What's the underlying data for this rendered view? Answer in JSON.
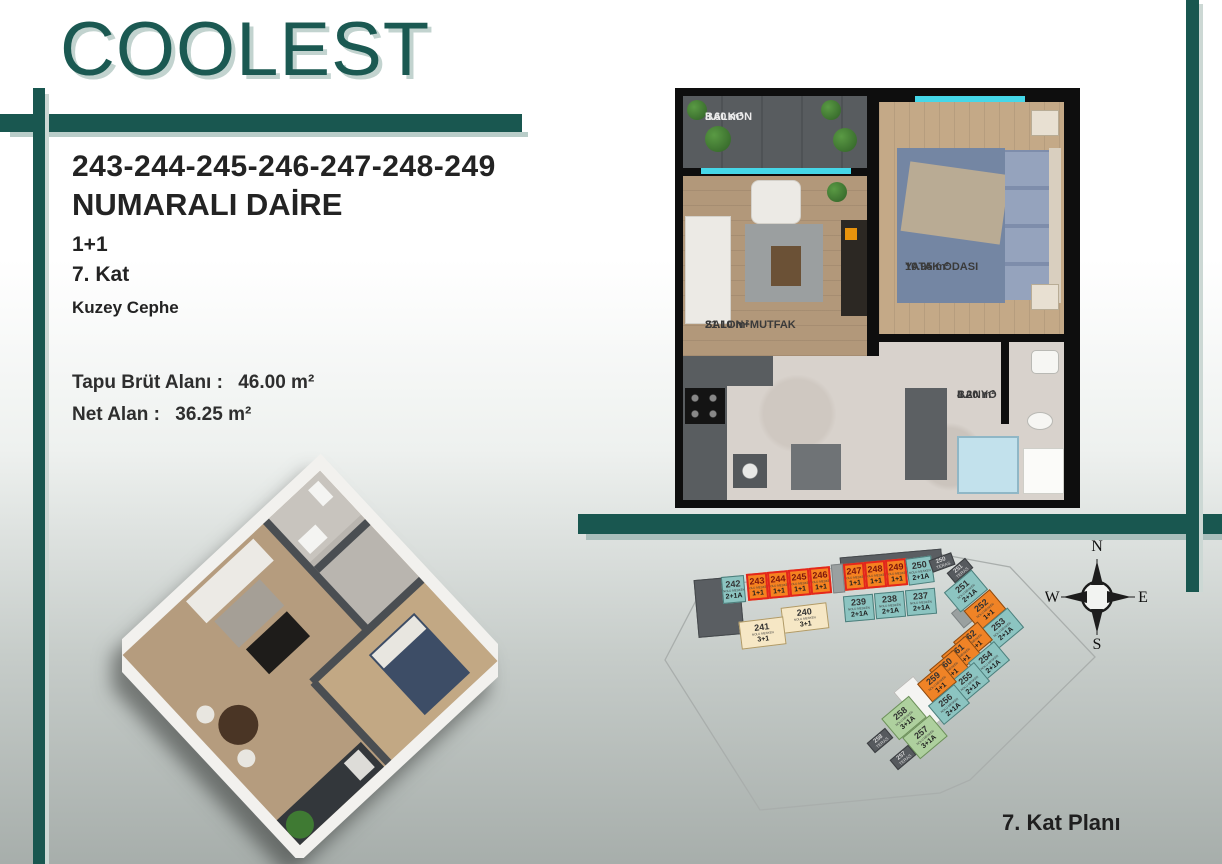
{
  "brand": {
    "logo_text": "COOLEST"
  },
  "info": {
    "unit_numbers": "243-244-245-246-247-248-249",
    "title": "NUMARALI DAİRE",
    "layout": "1+1",
    "floor": "7. Kat",
    "facade": "Kuzey Cephe",
    "gross_area_label": "Tapu Brüt Alanı :",
    "gross_area_value": "46.00 m²",
    "net_area_label": "Net Alan :",
    "net_area_value": "36.25 m²"
  },
  "floorplan": {
    "rooms": [
      {
        "name": "BALKON",
        "area": "3.60 m²"
      },
      {
        "name": "YATAK ODASI",
        "area": "10.95 m²"
      },
      {
        "name": "SALON+MUTFAK",
        "area": "21.10 m²"
      },
      {
        "name": "BANYO",
        "area": "4.20 m²"
      }
    ]
  },
  "siteplan": {
    "caption": "7. Kat Planı",
    "unit_sublabel": "NOLU MESKEN",
    "teras_label": "TERAS",
    "compass": {
      "north": "N",
      "south": "S",
      "east": "E",
      "west": "W"
    },
    "highlighted_units": [
      "243",
      "244",
      "245",
      "246",
      "247",
      "248",
      "249"
    ],
    "units": [
      {
        "num": "242",
        "type": "2+1A",
        "cls": "teal",
        "x": 62,
        "y": 31,
        "w": 23,
        "h": 27,
        "r": -5
      },
      {
        "num": "243",
        "type": "1+1",
        "cls": "hl",
        "x": 87,
        "y": 28,
        "w": 21,
        "h": 27,
        "r": -5
      },
      {
        "num": "244",
        "type": "1+1",
        "cls": "hl",
        "x": 108,
        "y": 26,
        "w": 21,
        "h": 27,
        "r": -5
      },
      {
        "num": "245",
        "type": "1+1",
        "cls": "hl",
        "x": 129,
        "y": 24,
        "w": 21,
        "h": 27,
        "r": -5
      },
      {
        "num": "246",
        "type": "1+1",
        "cls": "hl",
        "x": 150,
        "y": 22,
        "w": 21,
        "h": 27,
        "r": -5
      },
      {
        "num": "247",
        "type": "1+1",
        "cls": "hl",
        "x": 184,
        "y": 18,
        "w": 21,
        "h": 27,
        "r": -5
      },
      {
        "num": "248",
        "type": "1+1",
        "cls": "hl",
        "x": 205,
        "y": 16,
        "w": 21,
        "h": 27,
        "r": -5
      },
      {
        "num": "249",
        "type": "1+1",
        "cls": "hl",
        "x": 226,
        "y": 14,
        "w": 21,
        "h": 27,
        "r": -5
      },
      {
        "num": "250",
        "type": "2+1A",
        "cls": "teal",
        "x": 247,
        "y": 12,
        "w": 26,
        "h": 27,
        "r": -8
      },
      {
        "num": "239",
        "type": "2+1A",
        "cls": "teal",
        "x": 184,
        "y": 50,
        "w": 30,
        "h": 26,
        "r": -5
      },
      {
        "num": "238",
        "type": "2+1A",
        "cls": "teal",
        "x": 215,
        "y": 47,
        "w": 30,
        "h": 26,
        "r": -5
      },
      {
        "num": "237",
        "type": "2+1A",
        "cls": "teal",
        "x": 246,
        "y": 44,
        "w": 30,
        "h": 26,
        "r": -5
      },
      {
        "num": "240",
        "type": "3+1",
        "cls": "cream",
        "x": 122,
        "y": 60,
        "w": 46,
        "h": 26,
        "r": -7
      },
      {
        "num": "241",
        "type": "3+1",
        "cls": "cream",
        "x": 80,
        "y": 74,
        "w": 45,
        "h": 28,
        "r": -7
      },
      {
        "num": "250",
        "kind": "teras",
        "cls": "dark",
        "x": 270,
        "y": 11,
        "w": 24,
        "h": 13,
        "r": -20
      },
      {
        "num": "251",
        "kind": "teras",
        "cls": "dark",
        "x": 288,
        "y": 19,
        "w": 24,
        "h": 13,
        "r": -40
      },
      {
        "num": "251",
        "type": "2+1A",
        "cls": "teal",
        "x": 288,
        "y": 33,
        "w": 36,
        "h": 26,
        "r": -40
      },
      {
        "num": "252",
        "type": "1+1",
        "cls": "orange",
        "x": 308,
        "y": 52,
        "w": 34,
        "h": 26,
        "r": -40
      },
      {
        "num": "253",
        "type": "2+1A",
        "cls": "teal",
        "x": 324,
        "y": 71,
        "w": 36,
        "h": 26,
        "r": -40
      },
      {
        "num": "262",
        "type": "1+1",
        "cls": "orange",
        "x": 297,
        "y": 84,
        "w": 32,
        "h": 24,
        "r": -40
      },
      {
        "num": "261",
        "type": "1+1",
        "cls": "orange",
        "x": 285,
        "y": 98,
        "w": 32,
        "h": 24,
        "r": -40
      },
      {
        "num": "254",
        "type": "2+1A",
        "cls": "teal",
        "x": 312,
        "y": 104,
        "w": 34,
        "h": 25,
        "r": -40
      },
      {
        "num": "260",
        "type": "1+1",
        "cls": "orange",
        "x": 273,
        "y": 112,
        "w": 32,
        "h": 24,
        "r": -40
      },
      {
        "num": "255",
        "type": "2+1A",
        "cls": "teal",
        "x": 292,
        "y": 125,
        "w": 34,
        "h": 25,
        "r": -40
      },
      {
        "num": "259",
        "type": "1+1",
        "cls": "orange",
        "x": 261,
        "y": 126,
        "w": 32,
        "h": 24,
        "r": -40
      },
      {
        "num": "256",
        "type": "2+1A",
        "cls": "teal",
        "x": 272,
        "y": 147,
        "w": 34,
        "h": 25,
        "r": -40
      },
      {
        "num": "258",
        "type": "3+1A",
        "cls": "green",
        "x": 226,
        "y": 159,
        "w": 36,
        "h": 28,
        "r": -40
      },
      {
        "num": "257",
        "type": "3+1A",
        "cls": "green",
        "x": 247,
        "y": 178,
        "w": 36,
        "h": 28,
        "r": -40
      },
      {
        "num": "258",
        "kind": "teras",
        "cls": "dark",
        "x": 208,
        "y": 189,
        "w": 24,
        "h": 13,
        "r": -40
      },
      {
        "num": "257",
        "kind": "teras",
        "cls": "dark",
        "x": 231,
        "y": 206,
        "w": 24,
        "h": 13,
        "r": -40
      }
    ],
    "blocks": [
      {
        "cls": "dark-block",
        "x": 36,
        "y": 33,
        "w": 44,
        "h": 56,
        "r": -5
      },
      {
        "cls": "dark-block",
        "x": 180,
        "y": 8,
        "w": 100,
        "h": 11,
        "r": -5
      },
      {
        "cls": "gray-block",
        "x": 172,
        "y": 19,
        "w": 10,
        "h": 27,
        "r": -5
      },
      {
        "cls": "white-block",
        "x": 247,
        "y": 133,
        "w": 24,
        "h": 50,
        "r": -40
      },
      {
        "cls": "gray-block",
        "x": 296,
        "y": 62,
        "w": 10,
        "h": 18,
        "r": -40
      }
    ]
  },
  "colors": {
    "accent_teal": "#195750",
    "accent_shadow": "#b9cdc9",
    "highlight_red": "#e3261c",
    "unit_orange": "#f08326",
    "unit_teal": "#8cc4c1",
    "unit_cream": "#f6e7c5",
    "unit_green": "#aed09e",
    "unit_dark": "#565a5e",
    "window_cyan": "#45d7e8"
  }
}
